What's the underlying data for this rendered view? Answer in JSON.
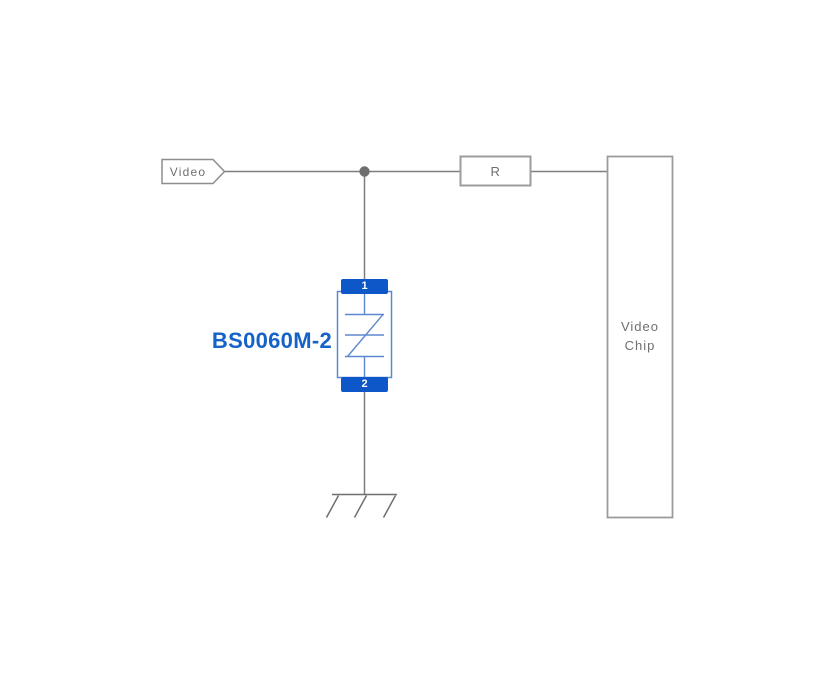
{
  "diagram": {
    "type": "circuit-schematic",
    "net_label": {
      "text": "Video"
    },
    "resistor": {
      "label": "R"
    },
    "video_chip": {
      "label": "Video Chip"
    },
    "esd_component": {
      "part_number": "BS0060M-2",
      "pin_top": "1",
      "pin_bottom": "2",
      "symbol": "bidirectional-tvs-diode"
    },
    "ground": {
      "style": "chassis-ground"
    },
    "colors": {
      "background": "#ffffff",
      "wire_gray": "#7e7e7e",
      "box_border_gray": "#9c9c9c",
      "junction_dot_gray": "#6e6e6e",
      "label_gray": "#6f6f6f",
      "component_pad_blue": "#0e57c8",
      "component_outline_blue": "#5d87cf",
      "part_number_blue": "#1562c9"
    }
  }
}
